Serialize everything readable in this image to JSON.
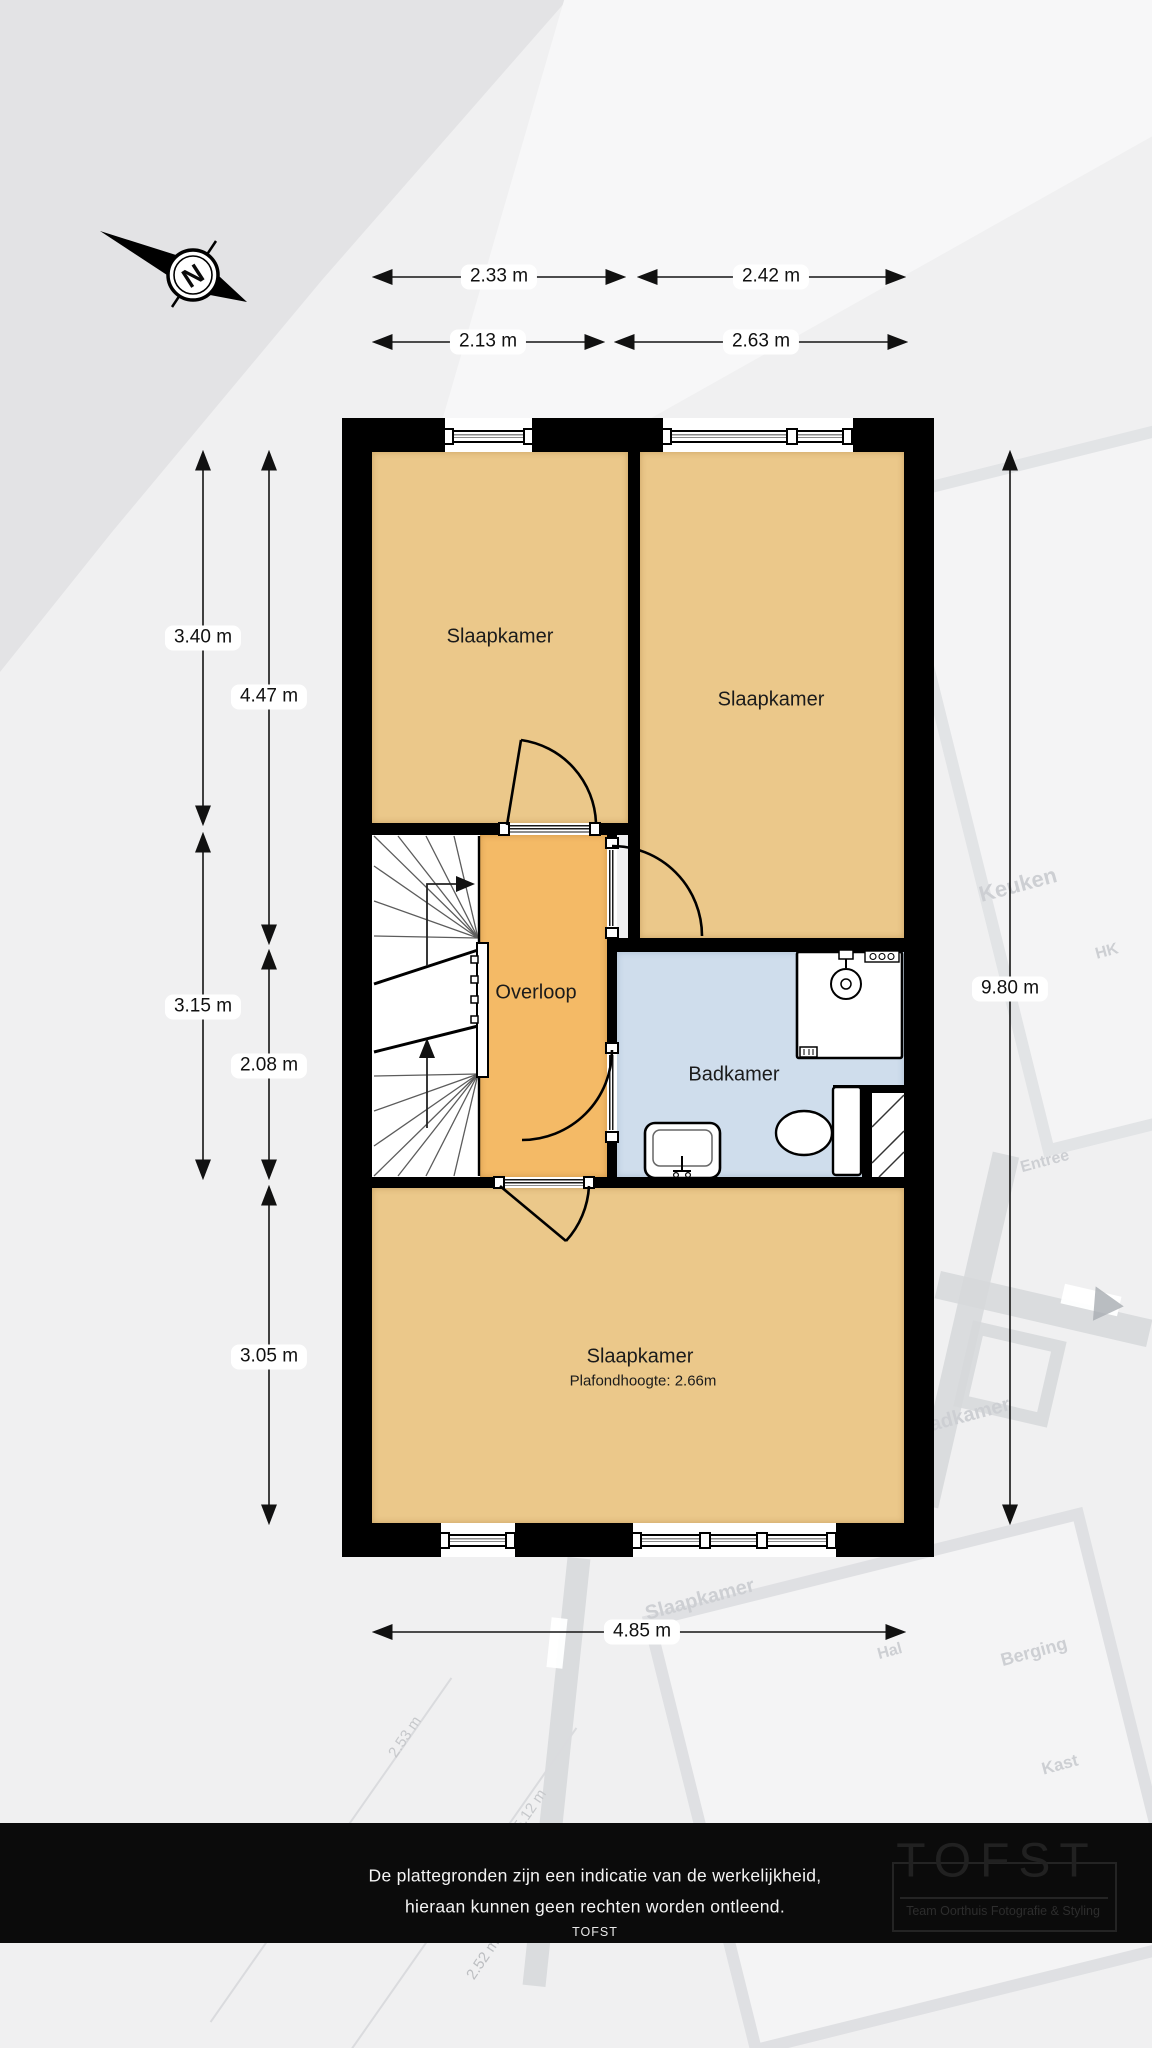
{
  "plan": {
    "compass": {
      "label": "N"
    },
    "rooms": {
      "bedroom_top_left": {
        "label": "Slaapkamer"
      },
      "bedroom_top_right": {
        "label": "Slaapkamer"
      },
      "landing": {
        "label": "Overloop"
      },
      "bathroom": {
        "label": "Badkamer"
      },
      "bedroom_bottom": {
        "label": "Slaapkamer",
        "ceiling_note": "Plafondhoogte: 2.66m"
      }
    },
    "colors": {
      "wall": "#000000",
      "bedroom": "#ebc88a",
      "landing": "#f4ba66",
      "bathroom": "#cfddec"
    }
  },
  "dimensions": {
    "top_row_outer": [
      {
        "label": "2.33 m"
      },
      {
        "label": "2.42 m"
      }
    ],
    "top_row_inner": [
      {
        "label": "2.13 m"
      },
      {
        "label": "2.63 m"
      }
    ],
    "left_outer": [
      {
        "label": "3.40 m"
      },
      {
        "label": "3.15 m"
      }
    ],
    "left_inner": [
      {
        "label": "4.47 m"
      },
      {
        "label": "2.08 m"
      },
      {
        "label": "3.05 m"
      }
    ],
    "right": {
      "label": "9.80 m"
    },
    "bottom": {
      "label": "4.85 m"
    }
  },
  "background_plan": {
    "labels": [
      {
        "text": "Keuken"
      },
      {
        "text": "HK"
      },
      {
        "text": "Entree"
      },
      {
        "text": "Badkamer"
      },
      {
        "text": "Slaapkamer"
      },
      {
        "text": "Hal"
      },
      {
        "text": "Berging"
      },
      {
        "text": "Kast"
      },
      {
        "text": "2.53 m"
      },
      {
        "text": "5.12 m"
      },
      {
        "text": "2.52 m"
      }
    ]
  },
  "footer": {
    "disclaimer_line1": "De plattegronden zijn een indicatie van de werkelijkheid,",
    "disclaimer_line2": "hieraan kunnen geen rechten worden ontleend.",
    "brand": "TOFST",
    "logo": {
      "title": "TOFST",
      "tagline": "Team Oorthuis Fotografie & Styling"
    }
  }
}
